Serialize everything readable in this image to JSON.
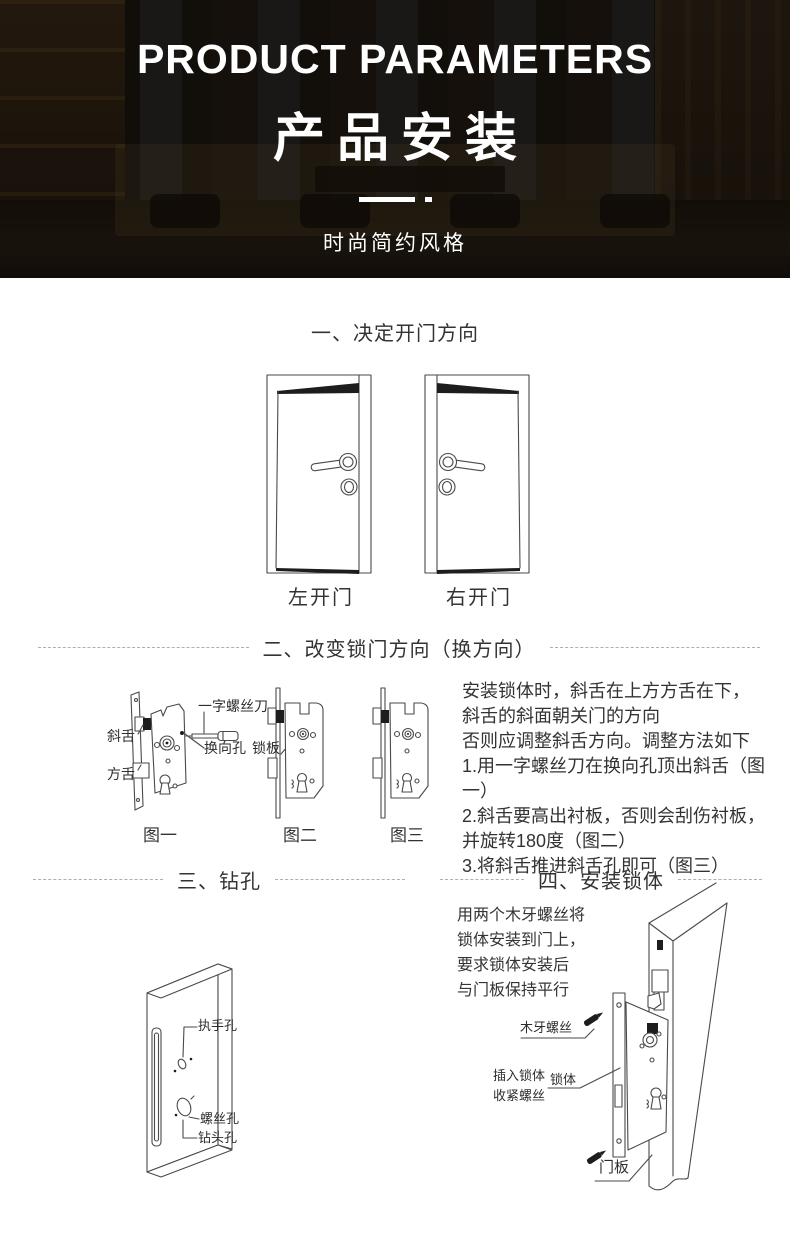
{
  "hero": {
    "title_en": "PRODUCT PARAMETERS",
    "title_cn": "产品安装",
    "subtitle": "时尚简约风格"
  },
  "sections": {
    "s1": {
      "heading": "一、决定开门方向",
      "door_left_label": "左开门",
      "door_right_label": "右开门"
    },
    "s2": {
      "heading": "二、改变锁门方向（换方向）",
      "labels": {
        "latch": "斜舌",
        "deadbolt": "方舌",
        "screwdriver": "一字螺丝刀",
        "reversing_hole": "换向孔",
        "lock_plate": "锁板"
      },
      "captions": [
        "图一",
        "图二",
        "图三"
      ],
      "lines": [
        "安装锁体时，斜舌在上方方舌在下，",
        "斜舌的斜面朝关门的方向",
        "否则应调整斜舌方向。调整方法如下",
        "1.用一字螺丝刀在换向孔顶出斜舌（图一）",
        "2.斜舌要高出衬板，否则会刮伤衬板，",
        "并旋转180度（图二）",
        "3.将斜舌推进斜舌孔即可（图三）"
      ]
    },
    "s3": {
      "heading": "三、钻孔",
      "labels": {
        "handle_hole": "执手孔",
        "screw_hole": "螺丝孔",
        "drill_hole": "钻头孔"
      }
    },
    "s4": {
      "heading": "四、安装锁体",
      "desc": [
        "用两个木牙螺丝将",
        "锁体安装到门上，",
        "要求锁体安装后",
        "与门板保持平行"
      ],
      "labels": {
        "wood_screw": "木牙螺丝",
        "insert_lock": "插入锁体",
        "tighten_screw": "收紧螺丝",
        "lock_body": "锁体",
        "door_panel": "门板"
      }
    }
  }
}
